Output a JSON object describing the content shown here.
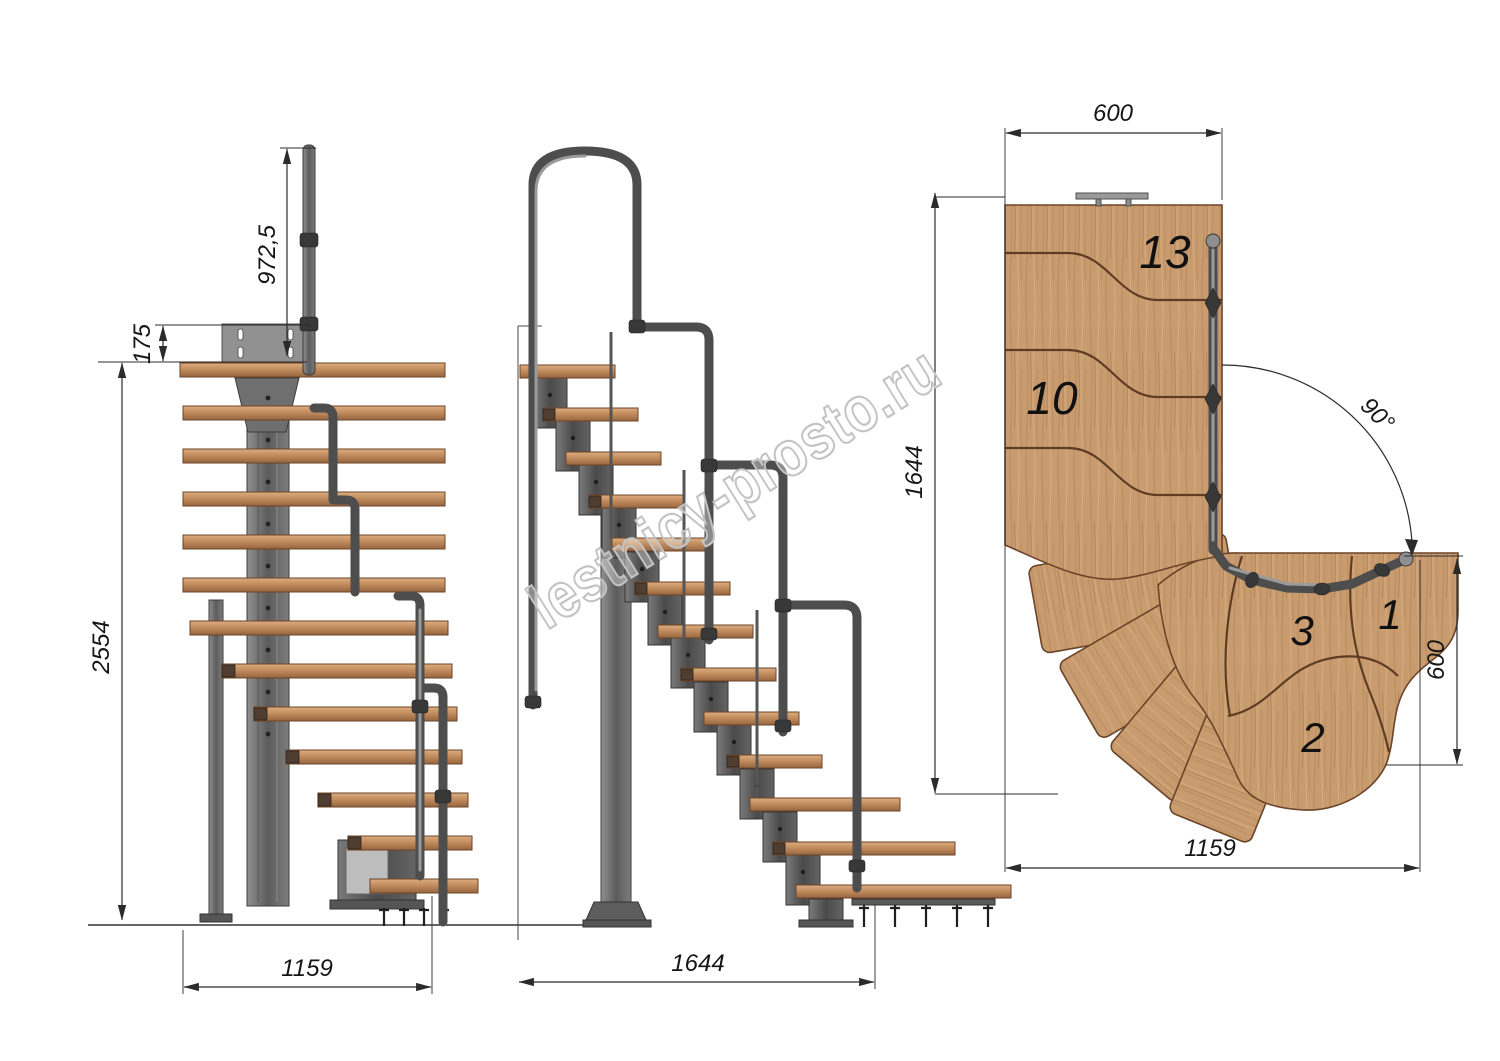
{
  "title": "Modular staircase with 90 degree turn - technical drawing",
  "watermark": {
    "text": "lestnicy-prosto.ru"
  },
  "front_view": {
    "dim_handrail_height": "972,5",
    "dim_plate_offset": "175",
    "dim_total_height": "2554",
    "dim_footprint_width": "1159"
  },
  "side_view": {
    "dim_footprint_length": "1644"
  },
  "plan_view": {
    "dim_top_width": "600",
    "dim_left_length": "1644",
    "dim_turn_angle": "90°",
    "dim_right_width": "600",
    "dim_bottom_length": "1159",
    "labels": {
      "step13": "13",
      "step10": "10",
      "step3": "3",
      "step2": "2",
      "step1": "1"
    }
  },
  "colors": {
    "wood": "#c99c6f",
    "wood_edge": "#6b4429",
    "metal": "#6e6e6e",
    "metal_dark": "#3e3e3e",
    "dimension": "#2b2b2b",
    "watermark_outline": "#c3c3c3"
  }
}
